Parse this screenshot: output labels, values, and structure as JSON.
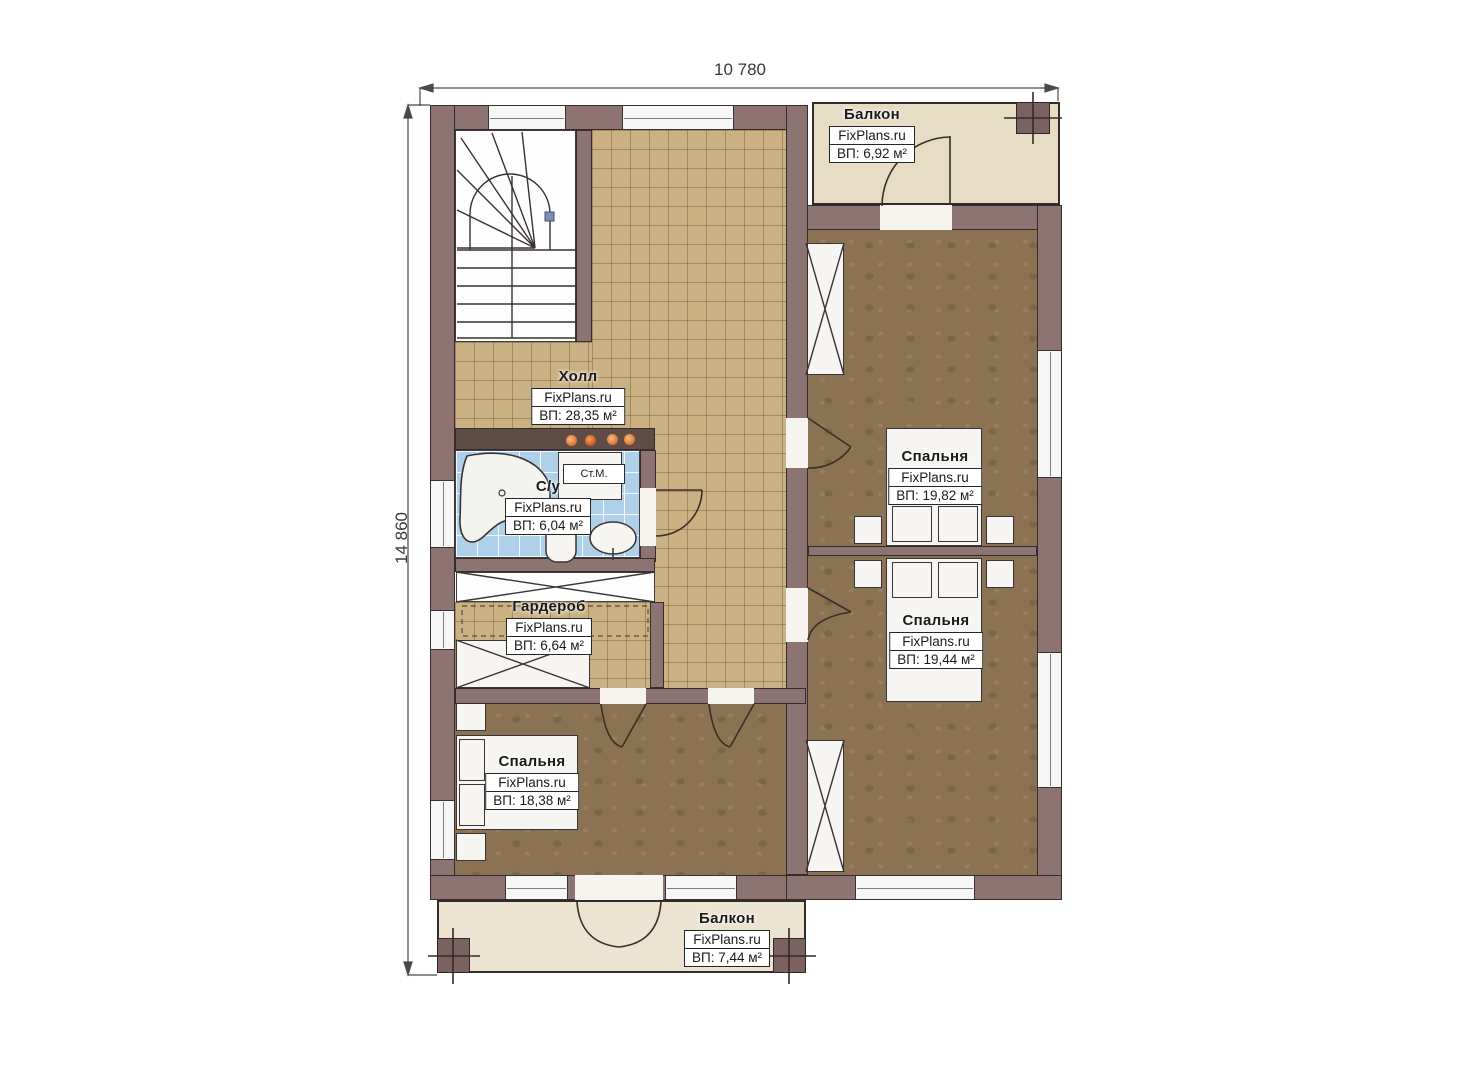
{
  "dimensions": {
    "width_label": "10 780",
    "height_label": "14 860"
  },
  "rooms": [
    {
      "id": "balcony-top",
      "name": "Балкон",
      "watermark": "FixPlans.ru",
      "area": "ВП: 6,92 м²"
    },
    {
      "id": "hall",
      "name": "Холл",
      "watermark": "FixPlans.ru",
      "area": "ВП: 28,35 м²"
    },
    {
      "id": "bathroom",
      "name": "С/у",
      "watermark": "FixPlans.ru",
      "area": "ВП: 6,04 м²"
    },
    {
      "id": "wardrobe",
      "name": "Гардероб",
      "watermark": "FixPlans.ru",
      "area": "ВП: 6,64 м²"
    },
    {
      "id": "bedroom-top-right",
      "name": "Спальня",
      "watermark": "FixPlans.ru",
      "area": "ВП: 19,82 м²"
    },
    {
      "id": "bedroom-bottom-right",
      "name": "Спальня",
      "watermark": "FixPlans.ru",
      "area": "ВП: 19,44 м²"
    },
    {
      "id": "bedroom-bottom-left",
      "name": "Спальня",
      "watermark": "FixPlans.ru",
      "area": "ВП: 18,38 м²"
    },
    {
      "id": "balcony-bottom",
      "name": "Балкон",
      "watermark": "FixPlans.ru",
      "area": "ВП: 7,44 м²"
    }
  ],
  "fixtures": {
    "washing_machine_label": "Ст.М."
  },
  "colors": {
    "wall": "#8d7473",
    "hall_tile": "#c9b183",
    "bedroom_floor": "#8a7253",
    "bathroom_tile": "#aed0e8",
    "balcony_floor": "#e7dcc4",
    "spotlight": "#df8440"
  }
}
